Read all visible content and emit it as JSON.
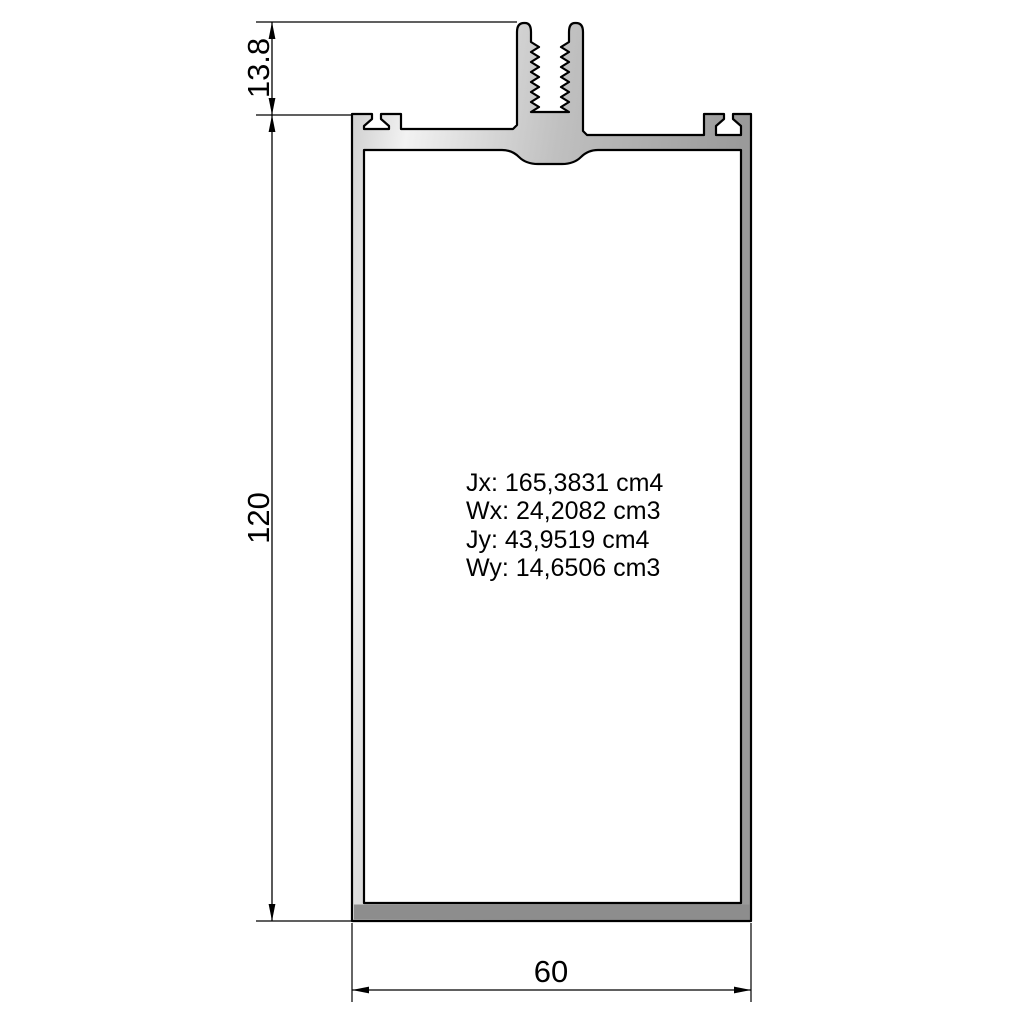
{
  "drawing": {
    "dims": {
      "offset_top": "13.8",
      "height": "120",
      "width": "60"
    },
    "properties": [
      "Jx: 165,3831 cm4",
      "Wx: 24,2082 cm3",
      "Jy: 43,9519 cm4",
      "Wy: 14,6506 cm3"
    ],
    "colors": {
      "background": "#ffffff",
      "outline": "#000000",
      "metal_edge": "#c6c6c6",
      "metal_highlight": "#f2f2f2",
      "metal_mid": "#c0c0c0",
      "metal_shadow": "#9a9a9a",
      "bottom_flange": "#8d8d8d"
    }
  }
}
